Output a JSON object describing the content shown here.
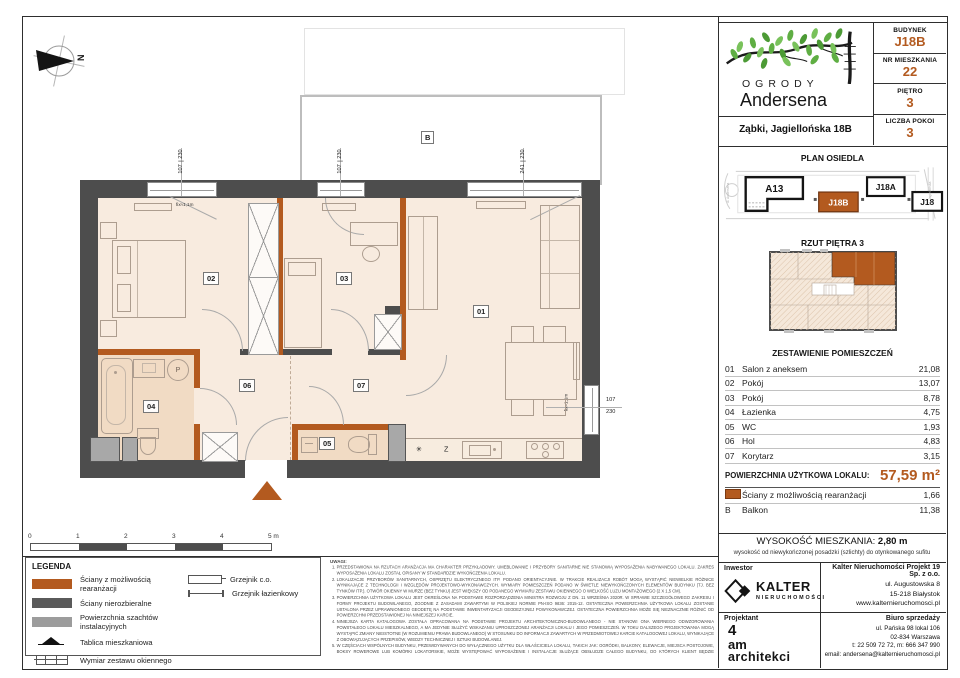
{
  "accent": "#b35a1f",
  "header": {
    "brand_top": "OGRODY",
    "brand_bottom": "Andersena",
    "address": "Ząbki, Jagiellońska 18B",
    "info": [
      {
        "label": "BUDYNEK",
        "value": "J18B"
      },
      {
        "label": "NR MIESZKANIA",
        "value": "22"
      },
      {
        "label": "PIĘTRO",
        "value": "3"
      },
      {
        "label": "LICZBA POKOI",
        "value": "3"
      }
    ]
  },
  "site_plan": {
    "title": "PLAN OSIEDLA",
    "buildings": {
      "a13": "A13",
      "j18b": "J18B",
      "j18a": "J18A",
      "j18": "J18"
    },
    "street_left": "ul. Andersena",
    "street_right": "ul. Jagiellońska"
  },
  "floor_overview": {
    "title": "RZUT PIĘTRA 3"
  },
  "rooms": {
    "title": "ZESTAWIENIE POMIESZCZEŃ",
    "rows": [
      {
        "no": "01",
        "name": "Salon z aneksem",
        "area": "21,08"
      },
      {
        "no": "02",
        "name": "Pokój",
        "area": "13,07"
      },
      {
        "no": "03",
        "name": "Pokój",
        "area": "8,78"
      },
      {
        "no": "04",
        "name": "Łazienka",
        "area": "4,75"
      },
      {
        "no": "05",
        "name": "WC",
        "area": "1,93"
      },
      {
        "no": "06",
        "name": "Hol",
        "area": "4,83"
      },
      {
        "no": "07",
        "name": "Korytarz",
        "area": "3,15"
      }
    ],
    "total_label": "POWIERZCHNIA UŻYTKOWA LOKALU:",
    "total_value": "57,59 m²",
    "walls_label": "Ściany z możliwością rearanżacji",
    "walls_area": "1,66",
    "balcony_no": "B",
    "balcony_name": "Balkon",
    "balcony_area": "11,38"
  },
  "height_info": {
    "label": "WYSOKOŚĆ MIESZKANIA:",
    "value": "2,80 m",
    "note": "wysokość od niewykończonej posadzki (szlichty) do otynkowanego sufitu"
  },
  "contacts": {
    "investor_label": "Inwestor",
    "brand": "KALTER",
    "brand_sub": "NIERUCHOMOŚCI",
    "company": "Kalter Nieruchomości Projekt 19 Sp. z o.o.",
    "company_lines": [
      "ul. Augustowska 8",
      "15-218 Białystok",
      "www.kalternieruchomosci.pl"
    ],
    "designer_label": "Projektant",
    "designer_lines": [
      "4",
      "am",
      "architekci"
    ],
    "sales_label": "Biuro sprzedaży",
    "sales_lines": [
      "ul. Pańska 98 lokal 106",
      "02-834 Warszawa",
      "t: 22 509 72 72, m: 666 347 990",
      "email: andersena@kalternieruchomosci.pl"
    ]
  },
  "legend": {
    "title": "LEGENDA",
    "items": [
      "Ściany z możliwością rearanżacji",
      "Ściany nierozbieralne",
      "Powierzchnia szachtów instalacyjnych",
      "Tablica mieszkaniowa",
      "Wymiar zestawu okiennego"
    ],
    "right_items": [
      "Grzejnik c.o.",
      "Grzejnik łazienkowy"
    ]
  },
  "notes": {
    "title": "UWAGI:",
    "items": [
      "PRZEDSTAWIONA NA RZUTACH ARANŻACJA MA CHARAKTER PRZYKŁADOWY. UMEBLOWANIE I PRZYBORY SANITARNE NIE STANOWIĄ WYPOSAŻENIA NABYWANEGO LOKALU. ZAKRES WYPOSAŻENIA LOKALU ZOSTAŁ OPISANY W STANDARDZIE WYKOŃCZENIA LOKALU.",
      "LOKALIZACJE PRZYBORÓW SANITARNYCH, OSPRZĘTU ELEKTRYCZNEGO ITP. PODANO ORIENTACYJNIE. W TRAKCIE REALIZACJI ROBÓT MOGĄ WYSTĄPIĆ NIEWIELKIE RÓŻNICE WYNIKAJĄCE Z TECHNOLOGII I WZGLĘDÓW PROJEKTOWO-WYKONAWCZYCH. WYMIARY POMIESZCZEŃ PODANO W ŚWIETLE NIEWYKOŃCZONYCH ELEMENTÓW BUDYNKU (TJ. BEZ TYNKÓW ITP.). OTWÓR OKIENNY W MURZE (BEZ TYNKU) JEST WIĘKSZY OD PODANEGO WYMIARU ZESTAWU OKIENNEGO O WIELKOŚĆ LUZU MONTAŻOWEGO (2 X 1,5 CM).",
      "POWIERZCHNIA UŻYTKOWA LOKALU JEST OKREŚLONA NA PODSTAWIE ROZPORZĄDZENIA MINISTRA ROZWOJU Z DN. 11 WRZEŚNIA 2020R. W SPRAWIE SZCZEGÓŁOWEGO ZAKRESU I FORMY PROJEKTU BUDOWLANEGO, ZGODNIE Z ZASADAMI ZAWARTYMI W POLSKIEJ NORMIE PN-ISO 9836: 2015-12. OSTATECZNA POWIERZCHNIA UŻYTKOWA LOKALU ZOSTANIE USTALONA PRZEZ UPRAWNIONEGO GEODETĘ NA PODSTAWIE INWENTARYZACJI GEODEZYJNEJ POWYKONAWCZEJ. OSTATECZNA POWIERZCHNIA MOŻE SIĘ NIEZNACZNIE RÓŻNIĆ OD POWIERZCHNI PRZEDSTAWIONEJ NA NINIEJSZEJ KARCIE.",
      "NINIEJSZA KARTA KATALOGOWA ZOSTAŁA OPRACOWANA NA PODSTAWIE PROJEKTU ARCHITEKTONICZNO-BUDOWLANEGO - NIE STANOWI ONA WIERNEGO ODWZOROWANIA POWSTAŁEGO LOKALU MIESZKALNEGO, A MA JEDYNIE SŁUŻYĆ WSKAZANIU UPROSZCZONEJ ARANŻACJI LOKALU I JEGO POMIESZCZEŃ. W TOKU DALSZEGO PROJEKTOWANIA MOGĄ WYSTĄPIĆ ZMIANY NIEISTOTNE (W ROZUMIENIU PRAWA BUDOWLANEGO) W STOSUNKU DO INFORMACJI ZAWARTYCH W PRZEDMIOTOWEJ KARCIE KATALOGOWEJ LOKALU, WYNIKAJĄCE Z OBOWIĄZUJĄCYCH PRZEPISÓW, WIEDZY TECHNICZNEJ I SZTUKI BUDOWLANEJ.",
      "W CZĘŚCIACH WSPÓLNYCH BUDYNKU, PRZEWIDYWANYCH DO WYŁĄCZNEGO UŻYTKU DLA WŁAŚCICIELA LOKALU, TAKICH JAK: OGRÓDKI, BALKONY, ELEWACJE, MIEJSCA POSTOJOWE, BOKSY ROWEROWE LUB KOMÓRKI LOKATORSKIE, MOŻE WYSTĘPOWAĆ WYPOSAŻENIE I INSTALACJE SŁUŻĄCE OBSŁUDZE CAŁEGO BUDYNKU, DO KTÓRYCH KLIENT BĘDZIE ZOBOWIĄZANY UMOŻLIWIĆ DOSTĘP.",
      "NINIEJSZA KARTA NIE PRZEDSTAWIA KOMPLETNEGO PROJEKTU WYKONAWCZEGO. RYSUNEK NIE JEST PRZEZNACZONY DO CELÓW WYKONAWCZYCH. SZCZEGÓŁOWE INFORMACJE PROJEKTOWE ZNAJDUJĄ SIĘ W DOKUMENTACJI TECHNICZNEJ (WYKONAWCZEJ) DOSTĘPNEJ DO WGLĄDU DLA KLIENTÓW W BIURZE INWESTORA.",
      "PROJEKT CHRONIONY PRAWEM AUTORSKIM."
    ]
  },
  "plan": {
    "north": "N",
    "balcony": "B",
    "rooms": {
      "r01": "01",
      "r02": "02",
      "r03": "03",
      "r04": "04",
      "r05": "05",
      "r06": "06",
      "r07": "07"
    },
    "windows": [
      {
        "w": "107",
        "h": "230"
      },
      {
        "w": "107",
        "h": "230"
      },
      {
        "w": "241",
        "h": "230"
      },
      {
        "w": "107",
        "h": "230"
      }
    ],
    "fix_label": "fix≈1,1m",
    "washer": "P",
    "fridge": "✳",
    "dishwasher": "Z"
  },
  "scalebar": {
    "labels": [
      "0",
      "1",
      "2",
      "3",
      "4",
      "5 m"
    ]
  }
}
